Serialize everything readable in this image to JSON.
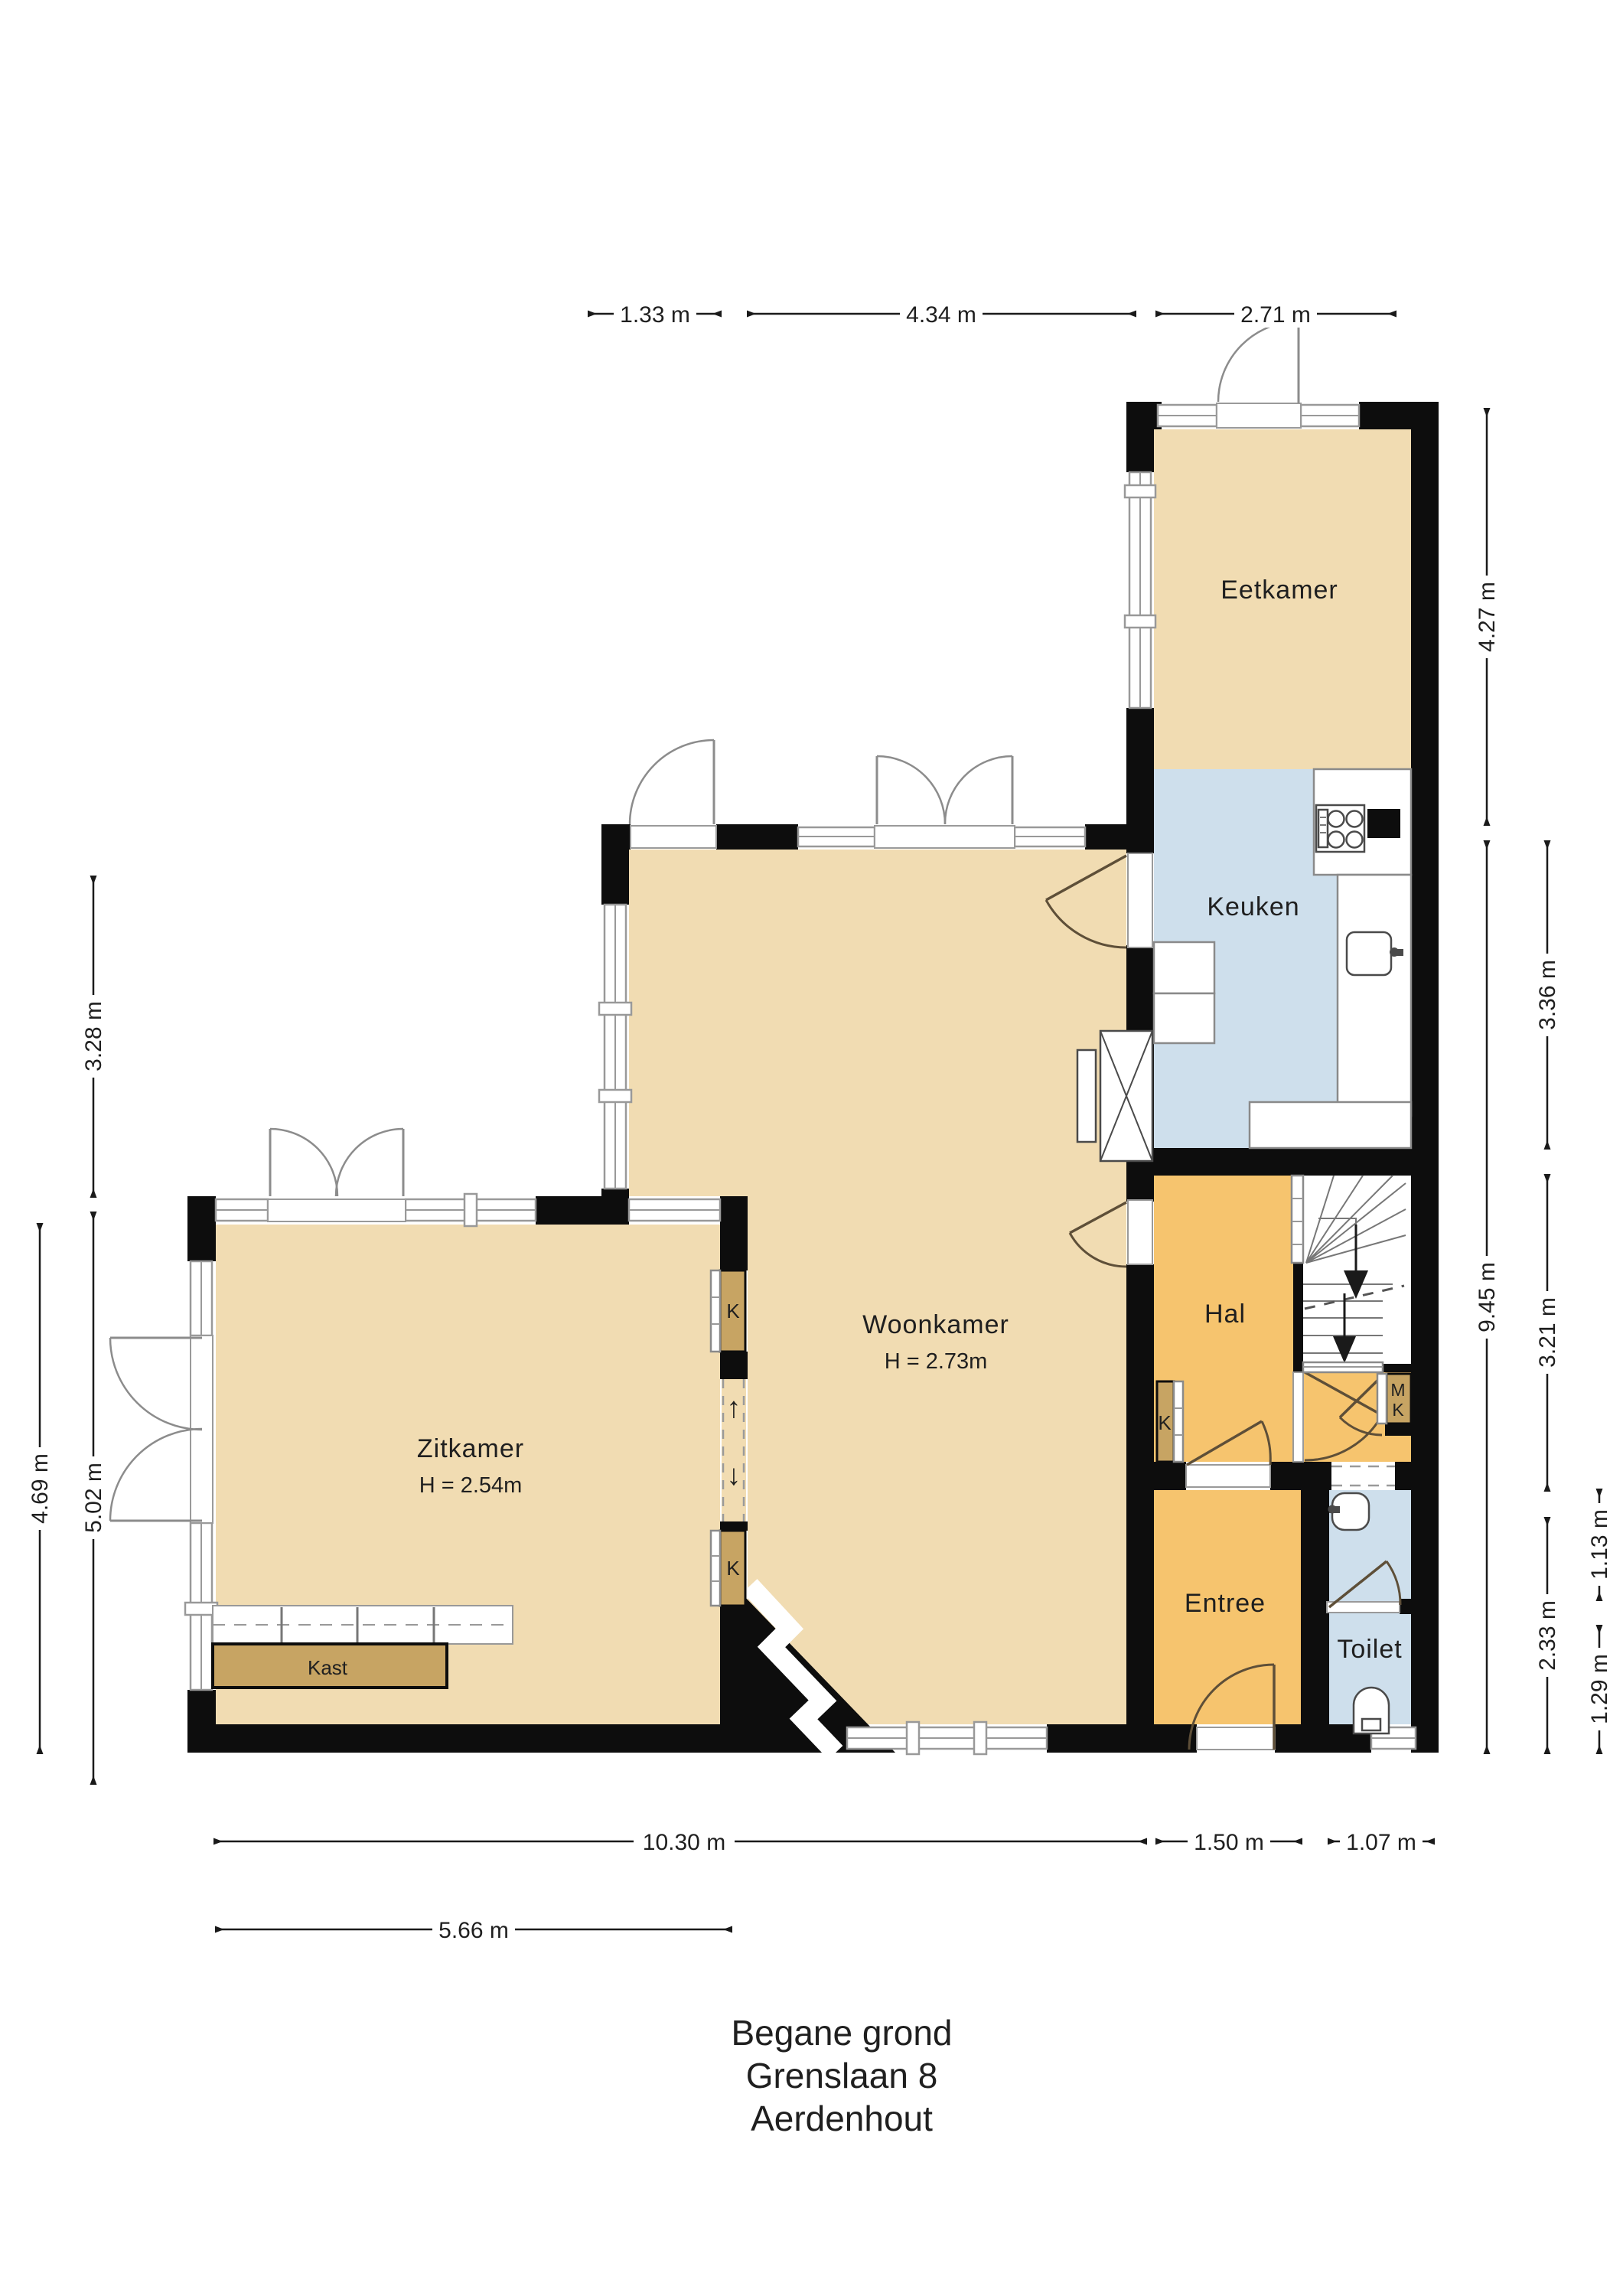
{
  "title": {
    "line1": "Begane grond",
    "line2": "Grenslaan 8",
    "line3": "Aerdenhout"
  },
  "rooms": {
    "eetkamer": {
      "label": "Eetkamer"
    },
    "keuken": {
      "label": "Keuken"
    },
    "woonkamer": {
      "label": "Woonkamer",
      "height": "H = 2.73m"
    },
    "zitkamer": {
      "label": "Zitkamer",
      "height": "H = 2.54m"
    },
    "hal": {
      "label": "Hal"
    },
    "entree": {
      "label": "Entree"
    },
    "toilet": {
      "label": "Toilet"
    }
  },
  "closets": {
    "kast": "Kast",
    "k_upper": "K",
    "k_lower": "K",
    "k_hal": "K",
    "mk_line1": "M",
    "mk_line2": "K"
  },
  "symbols": {
    "arrow_up": "↑",
    "arrow_down": "↓"
  },
  "dimensions": {
    "top": [
      "1.33 m",
      "4.34 m",
      "2.71 m"
    ],
    "right": [
      "4.27 m",
      "9.45 m",
      "3.36 m",
      "3.21 m",
      "2.33 m",
      "1.13 m",
      "1.29 m"
    ],
    "left": [
      "3.28 m",
      "5.02 m",
      "4.69 m"
    ],
    "bottom": [
      "10.30 m",
      "1.50 m",
      "1.07 m",
      "5.66 m"
    ]
  },
  "colors": {
    "floor_tan": "#F1DCB2",
    "floor_orange": "#F6C46E",
    "floor_blue": "#CEDFEC",
    "cabinet_brown": "#C7A463",
    "wall": "#0D0D0D",
    "window_frame": "#999999",
    "dimension": "#1A1A1A"
  }
}
